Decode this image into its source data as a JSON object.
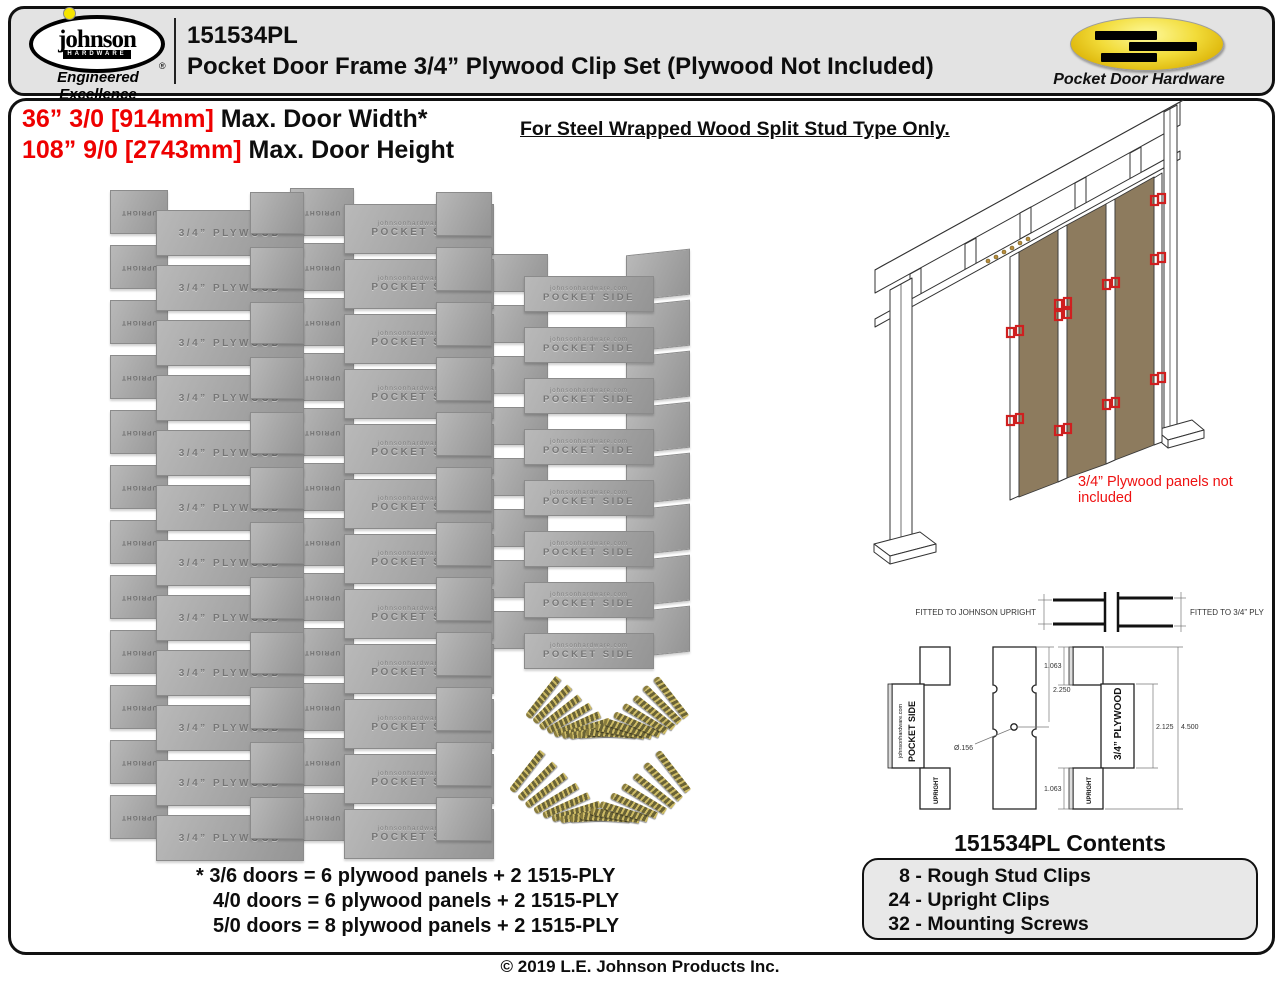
{
  "header": {
    "part_number": "151534PL",
    "product_title": "Pocket Door Frame 3/4” Plywood Clip Set (Plywood Not Included)",
    "logo": {
      "brand": "johnson",
      "sub_brand": "HARDWARE",
      "tagline": "Engineered Excellence",
      "registered": "®"
    },
    "right_logo_caption": "Pocket Door Hardware"
  },
  "specs": {
    "width_red": "36” 3/0 [914mm]",
    "width_black": " Max. Door Width*",
    "height_red": "108” 9/0 [2743mm]",
    "height_black": " Max. Door Height",
    "stud_note": "For Steel Wrapped Wood Split Stud Type Only."
  },
  "clips": {
    "columns": [
      {
        "type": "plywood",
        "count": 12,
        "stamp": "3/4” PLYWOOD",
        "tab_stamp": "UPRIGHT"
      },
      {
        "type": "pocket",
        "count": 12,
        "stamp_line1": "johnsonhardware.com",
        "stamp_line2": "POCKET SIDE",
        "tab_stamp": "UPRIGHT"
      },
      {
        "type": "rough",
        "count": 8,
        "stamp_line1": "johnsonhardware.com",
        "stamp_line2": "POCKET SIDE"
      }
    ]
  },
  "screws": {
    "fans": [
      {
        "count": 16
      },
      {
        "count": 16
      }
    ]
  },
  "illustration": {
    "note": "3/4” Plywood panels not included"
  },
  "diagram": {
    "fit_left": "FITTED TO JOHNSON UPRIGHT",
    "fit_right": "FITTED TO 3/4” PLY",
    "label_site": "johnsonhardware.com",
    "label_pocket_side": "POCKET SIDE",
    "label_upright_left": "UPRIGHT",
    "label_plywood": "3/4” PLYWOOD",
    "label_upright_right": "UPRIGHT",
    "dim_top_tab": "1.063",
    "dim_center": "2.250",
    "dim_hole": "Ø.156",
    "dim_body": "2.125",
    "dim_total": "4.500",
    "dim_bottom_tab": "1.063"
  },
  "contents": {
    "title": "151534PL Contents",
    "sep": " - ",
    "items": [
      {
        "qty": "8",
        "label": "Rough Stud Clips"
      },
      {
        "qty": "24",
        "label": "Upright Clips"
      },
      {
        "qty": "32",
        "label": "Mounting Screws"
      }
    ]
  },
  "footnotes": [
    "* 3/6 doors = 6 plywood panels + 2 1515-PLY",
    "4/0 doors = 6 plywood panels + 2 1515-PLY",
    "5/0 doors = 8 plywood panels + 2 1515-PLY"
  ],
  "footer": {
    "copyright": "© 2019 L.E. Johnson Products Inc."
  },
  "colors": {
    "accent_red": "#ee0000",
    "plywood_brown": "#8d7b5e",
    "clip_marker_red": "#cf1f1f",
    "screw_gold": "#cdbb65",
    "header_bg": "#e3e3e3",
    "contents_bg": "#e8e8e8"
  }
}
